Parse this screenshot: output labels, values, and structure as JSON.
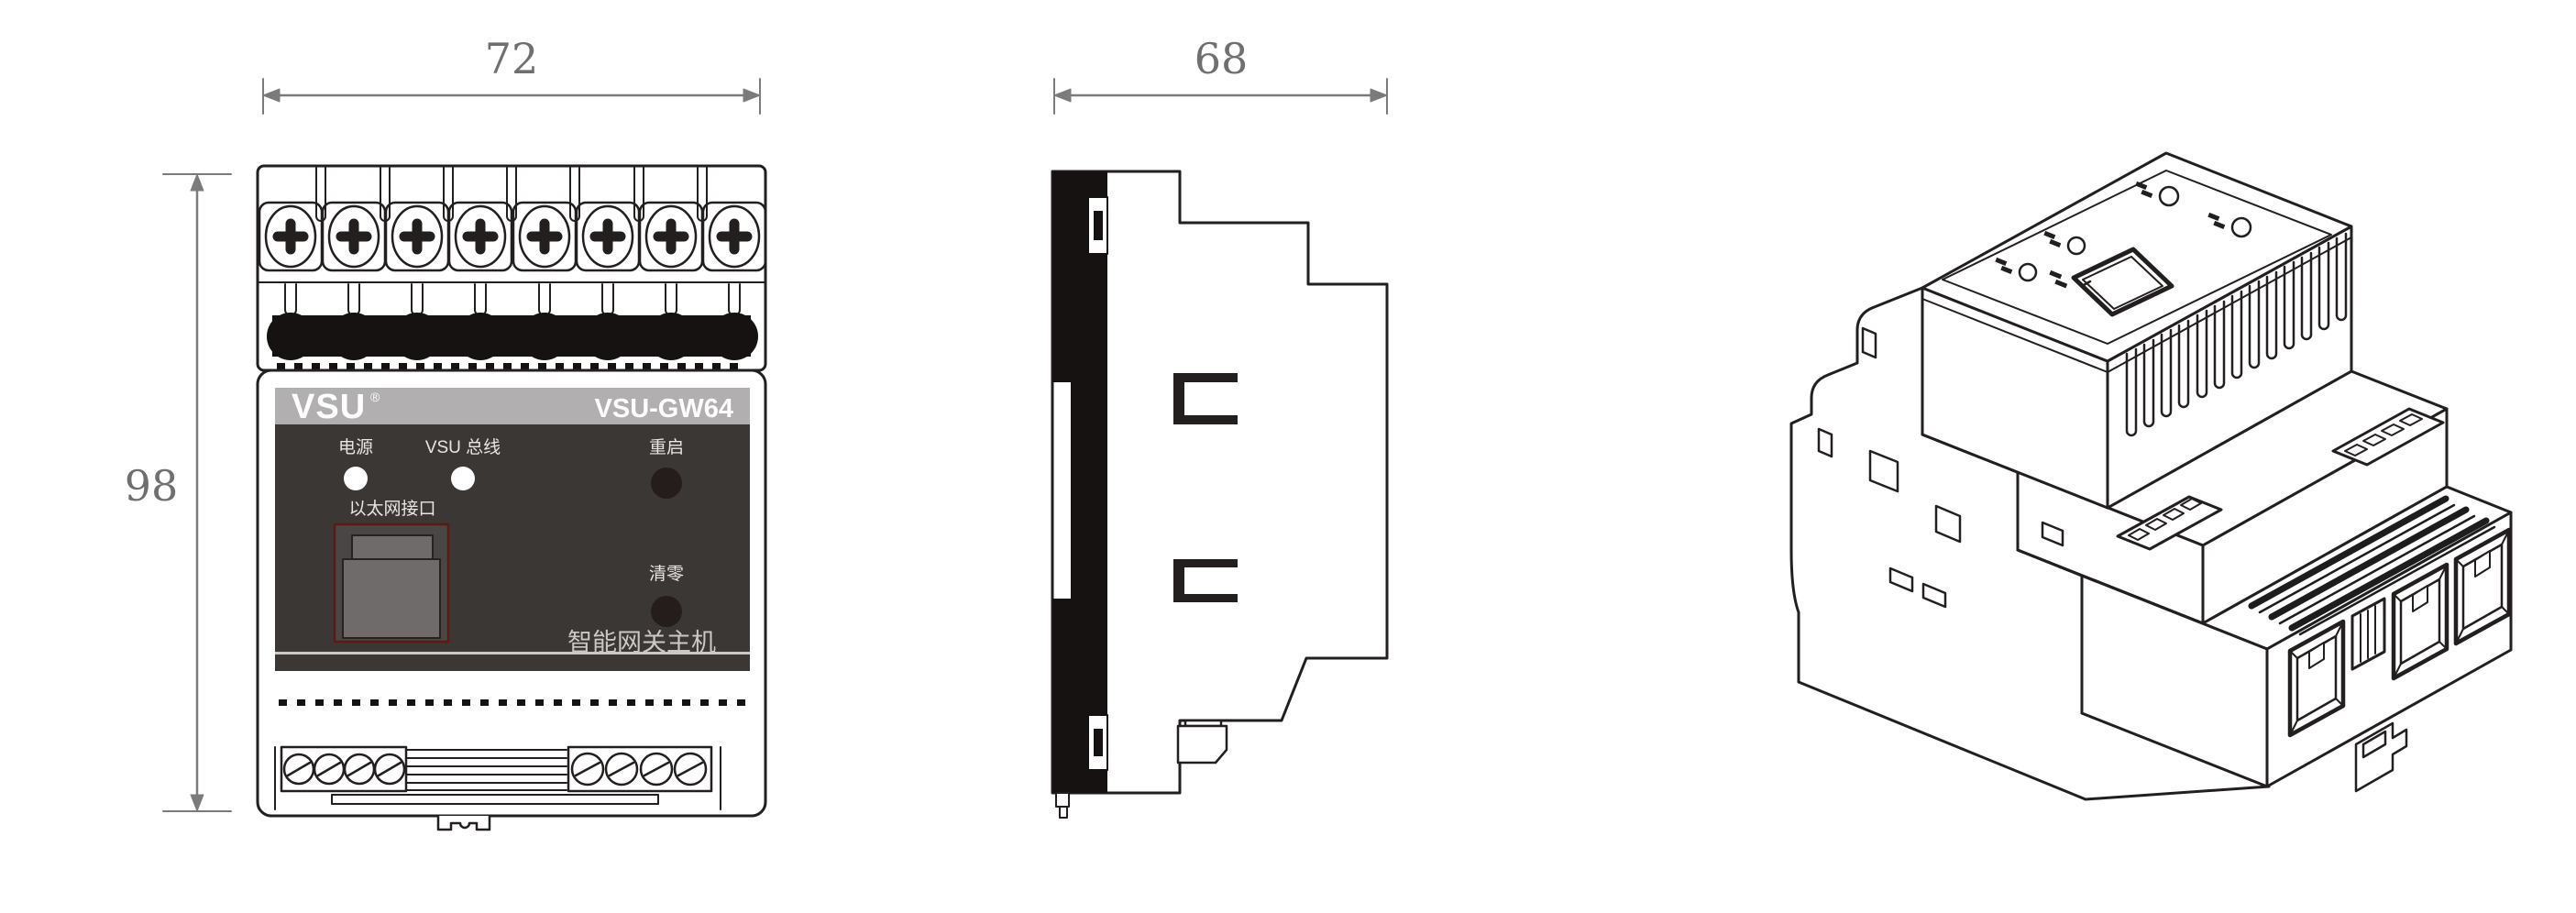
{
  "drawing": {
    "front_view": {
      "width_dim": "72",
      "height_dim": "98",
      "brand": "VSU",
      "registered_mark": "®",
      "model": "VSU-GW64",
      "label_power": "电源",
      "label_bus": "VSU 总线",
      "label_restart": "重启",
      "label_ethernet": "以太网接口",
      "label_clear": "清零",
      "label_product": "智能网关主机"
    },
    "side_view": {
      "depth_dim": "68"
    },
    "iso_view": {}
  },
  "colors": {
    "line": "#231f1e",
    "dim_line": "#7b7b7b",
    "dim_text": "#6f6f6f",
    "band_gray": "#b1afaf",
    "panel_dark": "#3b3734",
    "button_dark": "#251d1b",
    "led_white": "#ffffff",
    "connector_black": "#151211",
    "rj45_body": "#4a4645",
    "rj45_inner": "#6f6b6a",
    "rj45_border": "#5c1a12"
  }
}
